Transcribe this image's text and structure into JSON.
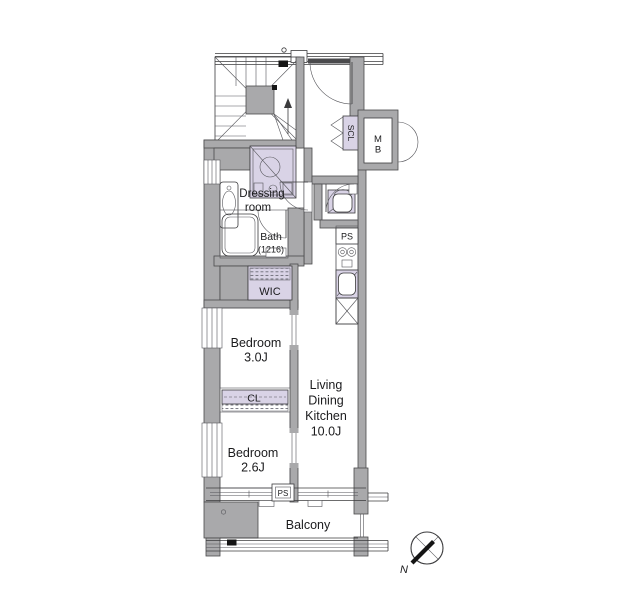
{
  "plan_title": "apartment floor plan",
  "labels": {
    "dressing": [
      "Dressing",
      "room"
    ],
    "bath": [
      "Bath",
      "(1216)"
    ],
    "wic": "WIC",
    "scl": "SCL",
    "mb": [
      "M",
      "B"
    ],
    "ps_kitchen": "PS",
    "ps_balcony": "PS",
    "bedroom3": [
      "Bedroom",
      "3.0J"
    ],
    "cl": "CL",
    "bedroom2": [
      "Bedroom",
      "2.6J"
    ],
    "ldk": [
      "Living",
      "Dining",
      "Kitchen",
      "10.0J"
    ],
    "balcony": "Balcony",
    "compass_north": "N"
  },
  "rooms": [
    {
      "name": "Living Dining Kitchen",
      "size": "10.0J"
    },
    {
      "name": "Bedroom",
      "size": "3.0J"
    },
    {
      "name": "Bedroom",
      "size": "2.6J"
    },
    {
      "name": "Bath",
      "size": "1216"
    },
    {
      "name": "Dressing room",
      "size": ""
    },
    {
      "name": "WIC",
      "size": ""
    },
    {
      "name": "Balcony",
      "size": ""
    }
  ],
  "colors": {
    "background": "#ffffff",
    "wall": "#a9a9ab",
    "fixture_shading": "#d9d3e6",
    "line": "#3b3b3d",
    "text": "#1b1b1d"
  }
}
